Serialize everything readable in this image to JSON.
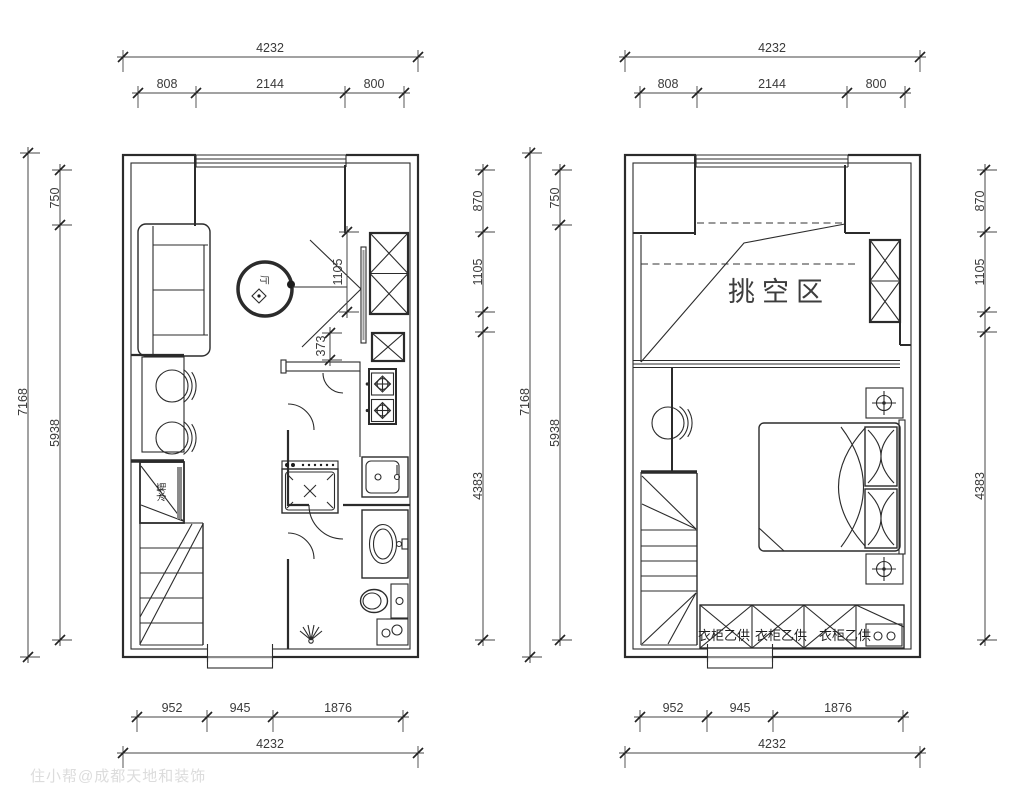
{
  "dims": {
    "total_w": "4232",
    "top_segments": [
      "808",
      "2144",
      "800"
    ],
    "bottom_segments": [
      "952",
      "945",
      "1876"
    ],
    "total_h": "7168",
    "left_segments": [
      "750",
      "5938"
    ],
    "right_segments": [
      "870",
      "1105",
      "4383"
    ],
    "interior_closet_height": "1105",
    "interior_gap": "373"
  },
  "labels": {
    "void_area": "挑空区",
    "wardrobe_note": "衣柜乙供",
    "living_room": "厅",
    "stair_storage": "冰箱"
  },
  "watermark": "住小帮@成都天地和装饰"
}
